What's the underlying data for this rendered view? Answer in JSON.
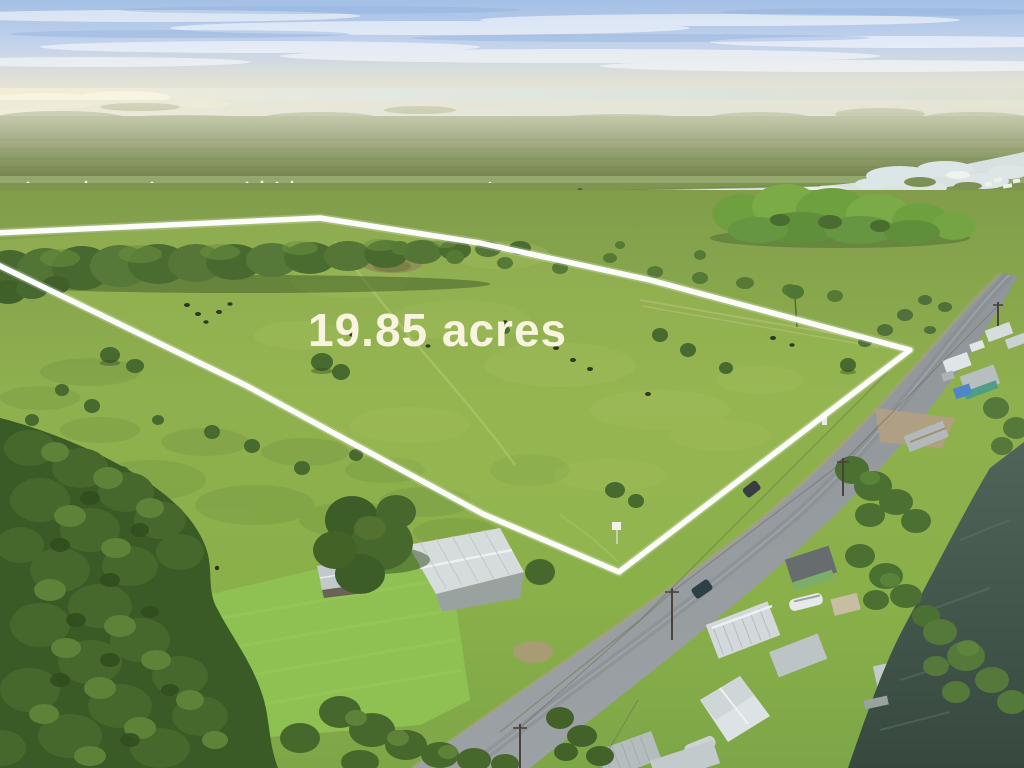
{
  "scene": {
    "kind": "aerial-drone-photo",
    "subject": "Rural pasture parcel for sale outlined in white, beside a country road with waterfront homes on a canal; river and marsh plain in the distance under a hazy blue sky",
    "overlay": {
      "acreage_label": "19.85 acres",
      "label_color": "#f8f4e0",
      "label_style": "color:#f8f4e0",
      "outline_color": "#ffffff"
    },
    "features": [
      "sky with thin clouds",
      "distant lake glint and marsh islands",
      "dark green marsh plain",
      "winding river with silver glint",
      "wetland pools and small white marina structures",
      "bright tree hammock",
      "white property boundary overlay",
      "19.85 acres text overlay",
      "scattered cattle and palms in pasture",
      "small white for-sale sign at parcel corner",
      "curving gray road with utility poles",
      "metal-roof houses, sheds, boats and blue tarp along road",
      "dark canal water with docks at bottom right",
      "homestead with mowed lawn, white metal roof and large oak",
      "dense woods at lower left with dirt two-track"
    ],
    "palette": {
      "sky_blue": "#a9c3e6",
      "haze_cream": "#e9e6d4",
      "distant_water": "#dde4e3",
      "marsh_green": "#74864f",
      "pasture_green": "#8fae4d",
      "parcel_green": "#9cbb55",
      "forest_green": "#3f6128",
      "road_gray": "#949a9d",
      "canal_dark": "#44584e"
    }
  }
}
